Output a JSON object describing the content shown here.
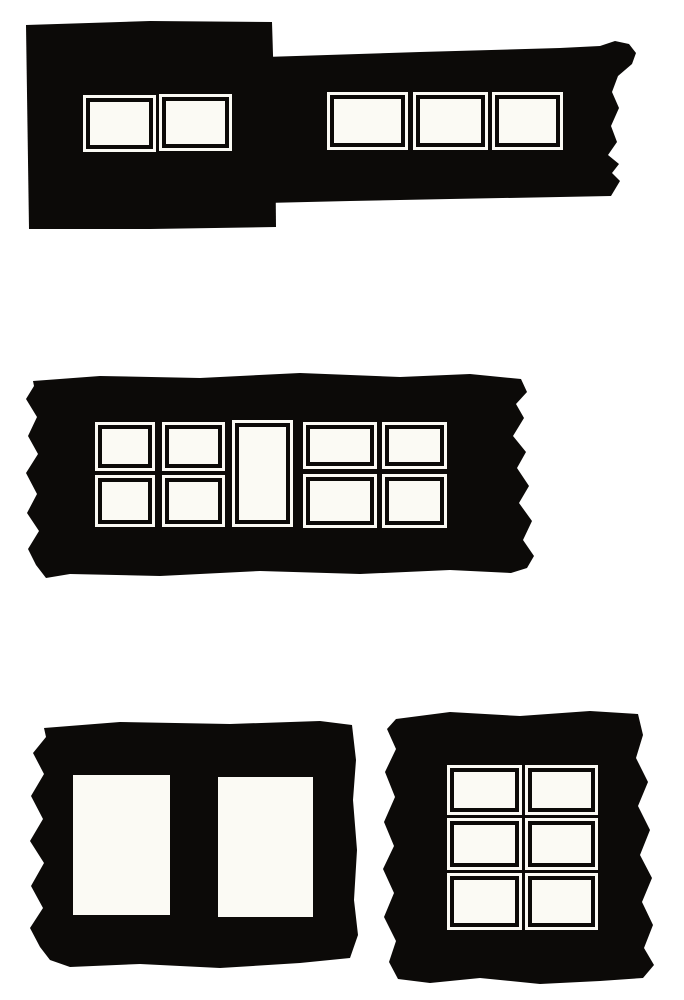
{
  "figure": {
    "description": "High-contrast print illustration of five torn black facade fragments pierced by white window openings",
    "colors": {
      "ink": "#0c0a08",
      "paper": "#ffffff",
      "pane": "#fbfaf4"
    },
    "panels": [
      {
        "id": "top-left-block",
        "window_count": 2,
        "window_style": "framed",
        "rows": 1,
        "cols": 2,
        "torn_edge": "none"
      },
      {
        "id": "top-strip",
        "window_count": 3,
        "window_style": "framed",
        "rows": 1,
        "cols": 3,
        "torn_edge": "right"
      },
      {
        "id": "middle-strip",
        "window_count": 9,
        "window_style": "framed",
        "layout": "2x2 grid, 2x2 grid, tall center pane, 2x2 grid, 2x2 grid",
        "torn_edge": "left and right"
      },
      {
        "id": "bottom-left-panel",
        "window_count": 2,
        "window_style": "plain",
        "rows": 1,
        "cols": 2,
        "torn_edge": "left"
      },
      {
        "id": "bottom-right-panel",
        "window_count": 6,
        "window_style": "framed",
        "rows": 3,
        "cols": 2,
        "torn_edge": "left and right"
      }
    ]
  }
}
